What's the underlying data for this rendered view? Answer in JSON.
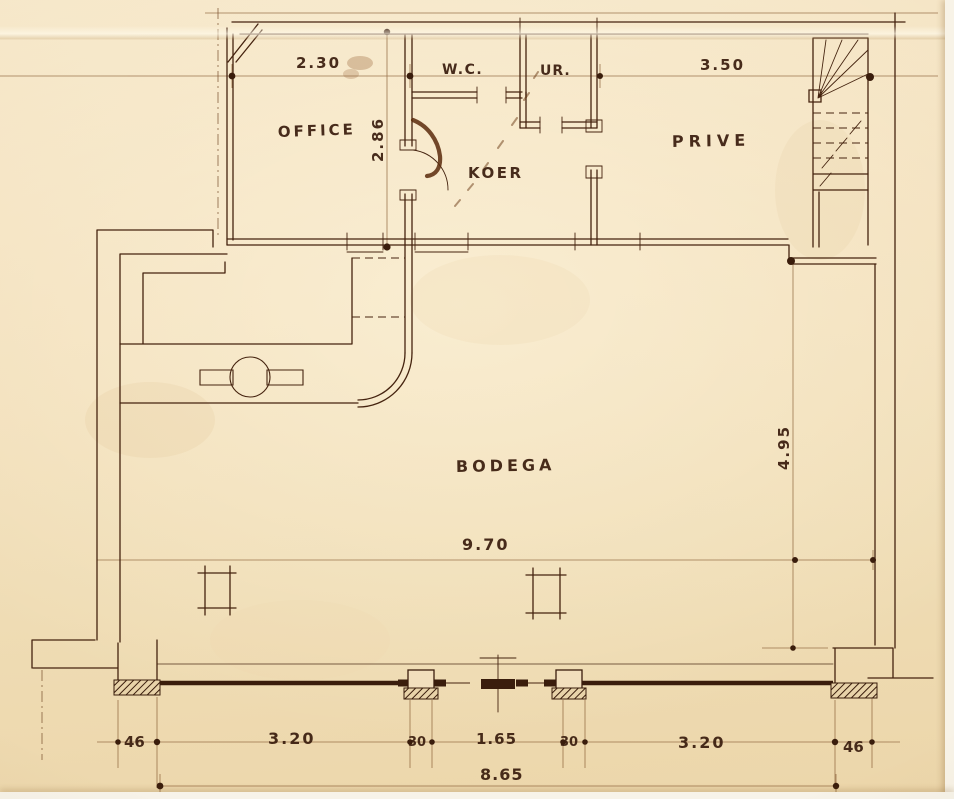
{
  "rooms": {
    "office": "OFFICE",
    "wc": "W.C.",
    "ur": "UR.",
    "koer": "KOER",
    "prive": "PRIVE",
    "bodega": "BODEGA"
  },
  "dimensions": {
    "office_width": "2.30",
    "office_depth": "2.86",
    "prive_width": "3.50",
    "bodega_length": "9.70",
    "bodega_depth": "4.95",
    "front_left_pier": "46",
    "front_left_bay": "3.20",
    "front_left_mullion": "30",
    "front_center_bay": "1.65",
    "front_right_mullion": "30",
    "front_right_bay": "3.20",
    "front_right_pier": "46",
    "front_total": "8.65"
  },
  "colors": {
    "ink": "#45230f",
    "faint_ink": "#8b6138",
    "paper": "#f2dfbd",
    "stain": "#5a2a0c"
  }
}
